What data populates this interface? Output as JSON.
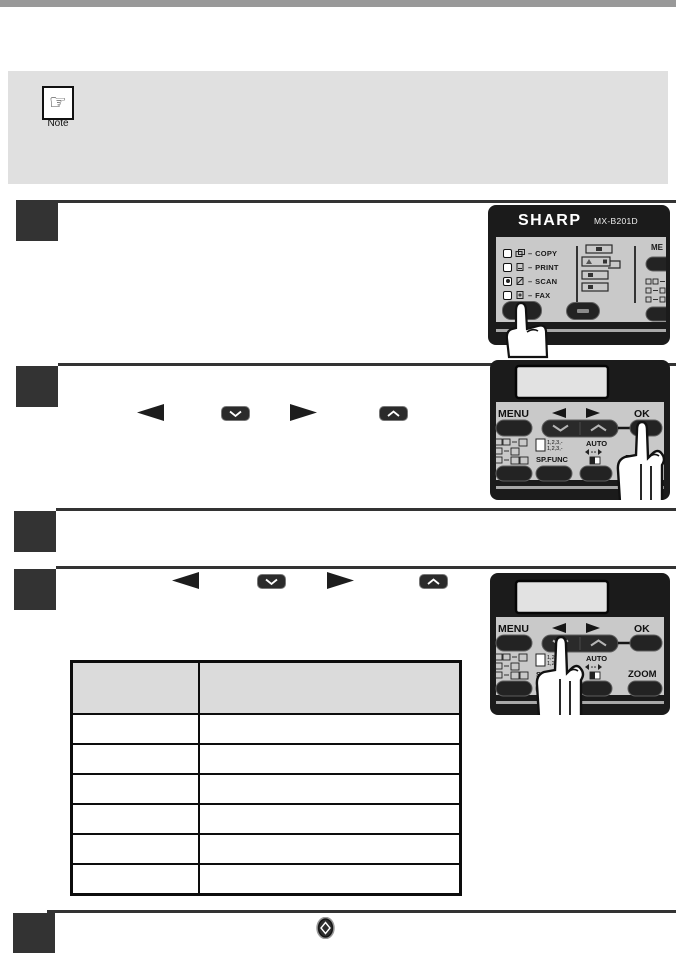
{
  "colors": {
    "top_bar": "#999999",
    "note_bg": "#e0e0e0",
    "step_block": "#333333",
    "panel_frame": "#1b1b1b",
    "panel_body": "#c9c9c9",
    "display_bg": "#e2e2e2",
    "table_header_bg": "#dbdbdb"
  },
  "note": {
    "label": "Note",
    "icon_glyph": "☞"
  },
  "icons": {
    "left_arrow": "◄",
    "right_arrow": "►",
    "down_key": "∨",
    "up_key": "∧",
    "start_key": "◇"
  },
  "panel1": {
    "brand": "SHARP",
    "model": "MX-B201D",
    "sep": "–",
    "modes": [
      {
        "label": "COPY"
      },
      {
        "label": "PRINT"
      },
      {
        "label": "SCAN"
      },
      {
        "label": "FAX"
      }
    ],
    "active_mode": "SCAN",
    "menu_partial": "ME"
  },
  "panel2": {
    "menu": "MENU",
    "ok": "OK",
    "sort_line1": "1,2,3,-",
    "sort_line2": "1,2,3,-",
    "sp_func": "SP.FUNC",
    "auto": "AUTO",
    "zoom_left": "Z",
    "zoom_right": "M"
  },
  "panel3": {
    "menu": "MENU",
    "ok": "OK",
    "sort_line1": "1,2,3,-",
    "sort_line2": "1,2,3,-",
    "sp_func": "SP.FUNC",
    "auto": "AUTO",
    "zoom": "ZOOM"
  },
  "table": {
    "columns": [
      "",
      ""
    ],
    "rows": [
      [
        "",
        ""
      ],
      [
        "",
        ""
      ],
      [
        "",
        ""
      ],
      [
        "",
        ""
      ],
      [
        "",
        ""
      ],
      [
        "",
        ""
      ]
    ]
  }
}
